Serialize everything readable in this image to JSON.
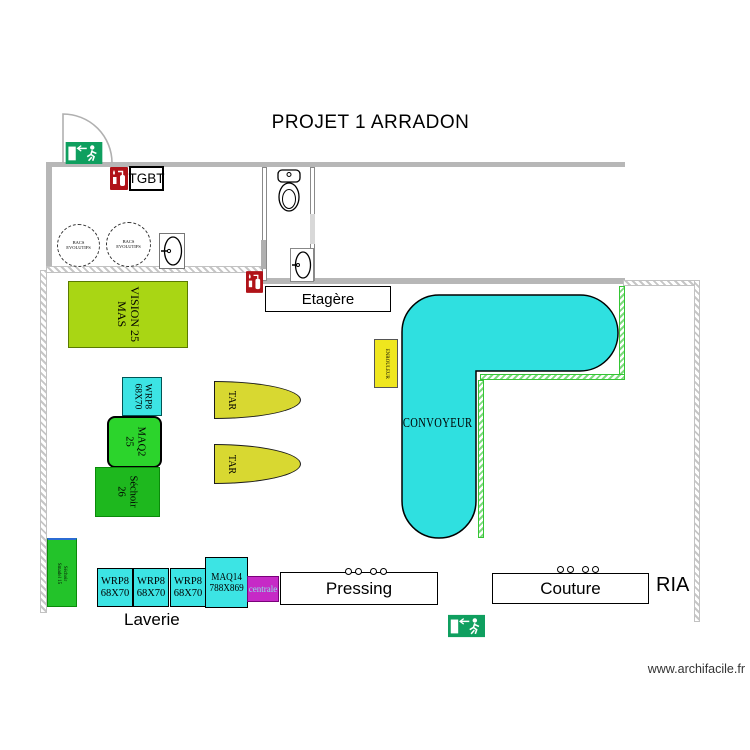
{
  "title": "PROJET 1 ARRADON",
  "watermark": "www.archifacile.fr",
  "rooms": {
    "laverie": "Laverie",
    "ria": "RIA"
  },
  "boxes": {
    "tgbt": "TGBT",
    "etagere": "Etagère",
    "pressing": "Pressing",
    "couture": "Couture"
  },
  "machines": {
    "vision": [
      "VISION 25",
      "MAS"
    ],
    "wrp8_vertical": [
      "WRP8",
      "68X70"
    ],
    "maq2": [
      "MAQ2",
      "25"
    ],
    "sechoir26": [
      "Séchoir",
      "26"
    ],
    "tar_top": "TAR",
    "tar_bottom": "TAR",
    "enrouleur": "ENROULEUR",
    "convoyeur": "CONVOYEUR",
    "sechoir_left": [
      "Séchoir",
      "Smadel 15"
    ],
    "wrp8_row": [
      [
        "WRP8",
        "68X70"
      ],
      [
        "WRP8",
        "68X70"
      ],
      [
        "WRP8",
        "68X70"
      ]
    ],
    "maq14": [
      "MAQ14",
      "788X869"
    ],
    "centrale": "centrale",
    "bac1": [
      "BACS",
      "EVOLUTIFS"
    ],
    "bac2": [
      "BACS",
      "EVOLUTIFS"
    ]
  },
  "colors": {
    "machine_cyan": "#3ce4e4",
    "conveyor_cyan": "#2fe0e0",
    "vision_green": "#a9d614",
    "maq2_green": "#2cd42c",
    "sechoir_green": "#1eb81e",
    "sechoir_left_green": "#23c32a",
    "tar_yellow": "#d8d831",
    "enrouleur_yellow": "#efe61e",
    "centrale_magenta": "#c62ac6",
    "exit_green": "#0f9f5f",
    "sign_red": "#b01218",
    "wall_gray": "#b7b7b7",
    "guard_green": "#35c535"
  }
}
